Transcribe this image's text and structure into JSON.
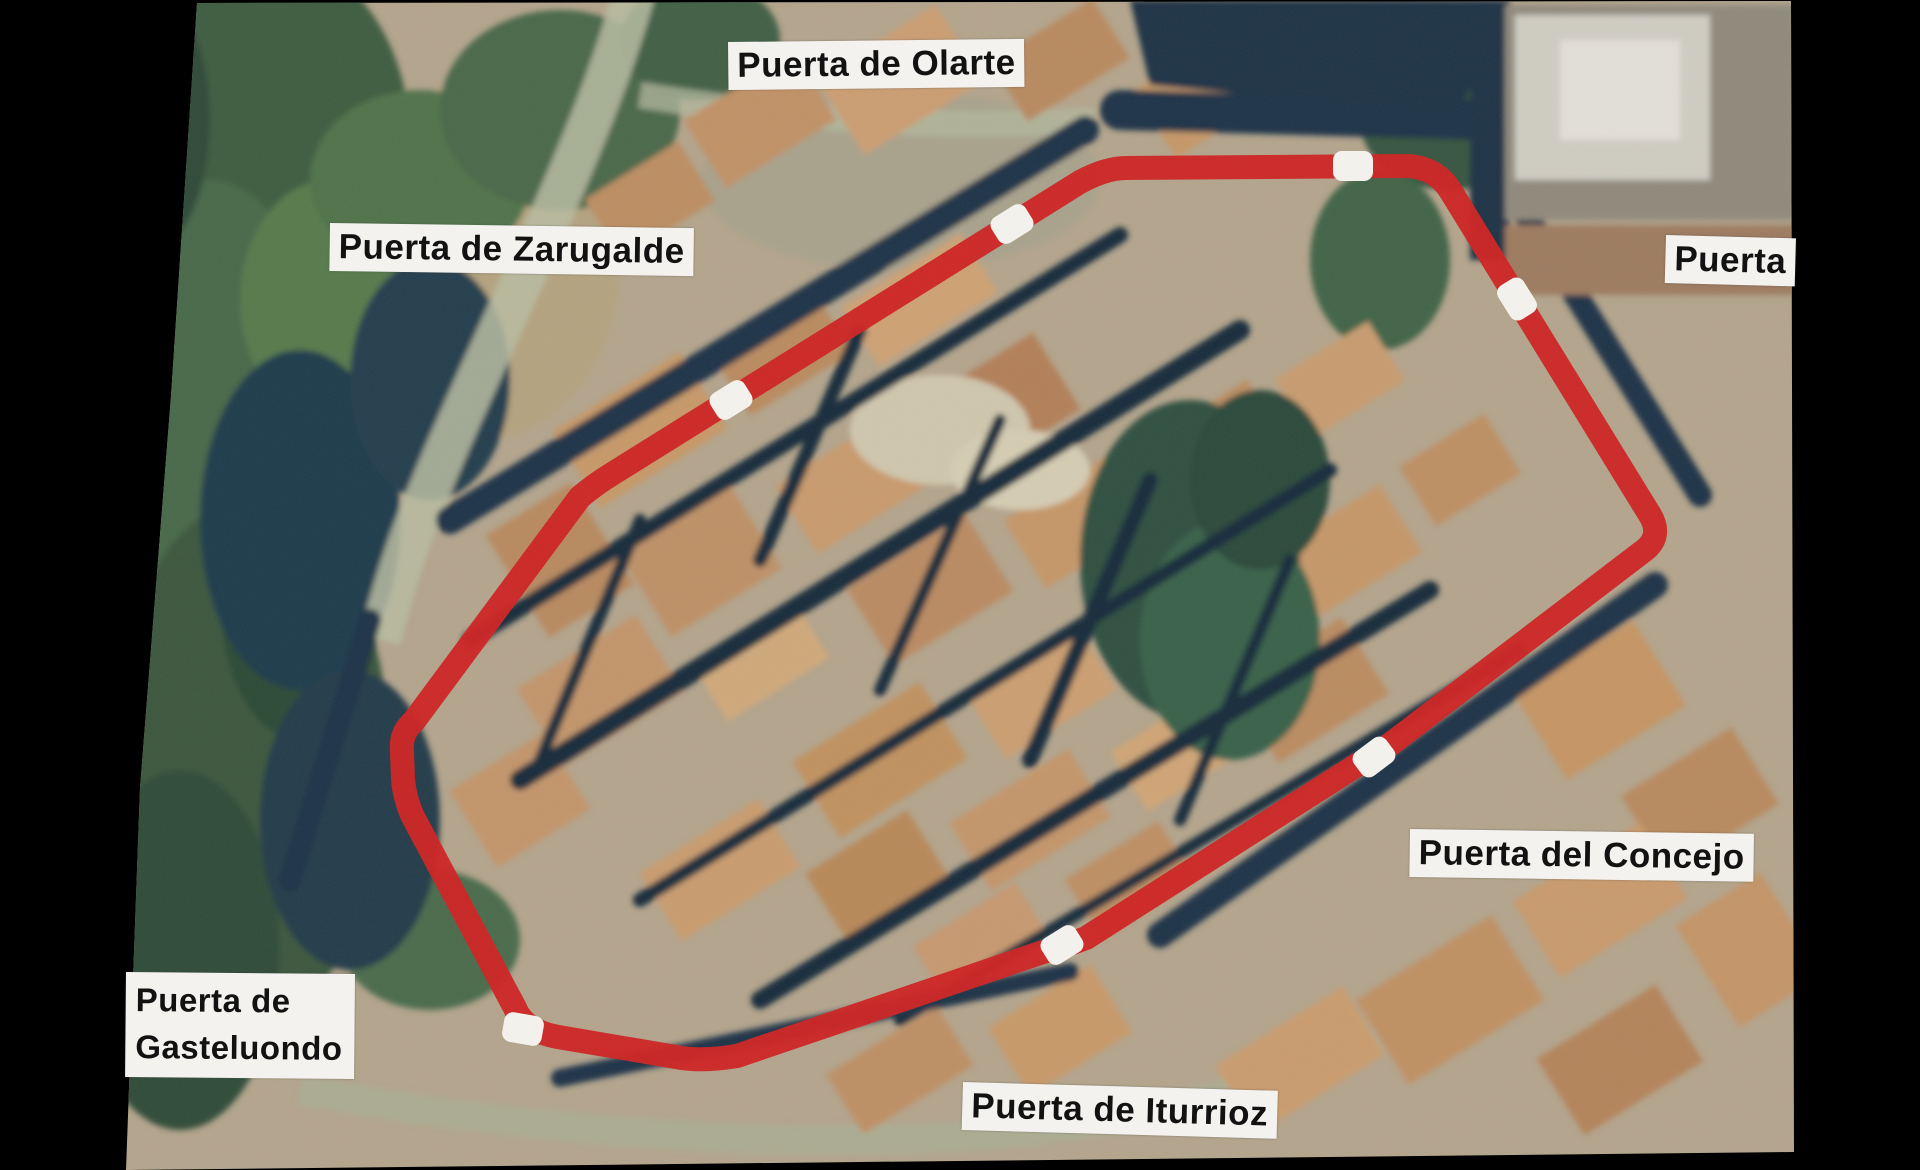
{
  "map": {
    "type": "aerial-photo-map",
    "labels": {
      "olarte": "Puerta de Olarte",
      "zarugalde": "Puerta de Zarugalde",
      "puerta_east": "Puerta",
      "concejo": "Puerta del Concejo",
      "gasteluondo_line1": "Puerta de",
      "gasteluondo_line2": "Gasteluondo",
      "iturrioz": "Puerta de Iturrioz"
    },
    "colors": {
      "background": "#000000",
      "wall_outline_red": "#cd2121",
      "gate_marker_white": "#f5f3ef",
      "label_background": "#f3f2ef",
      "label_text": "#121212"
    },
    "gate_marker_count": 7
  }
}
